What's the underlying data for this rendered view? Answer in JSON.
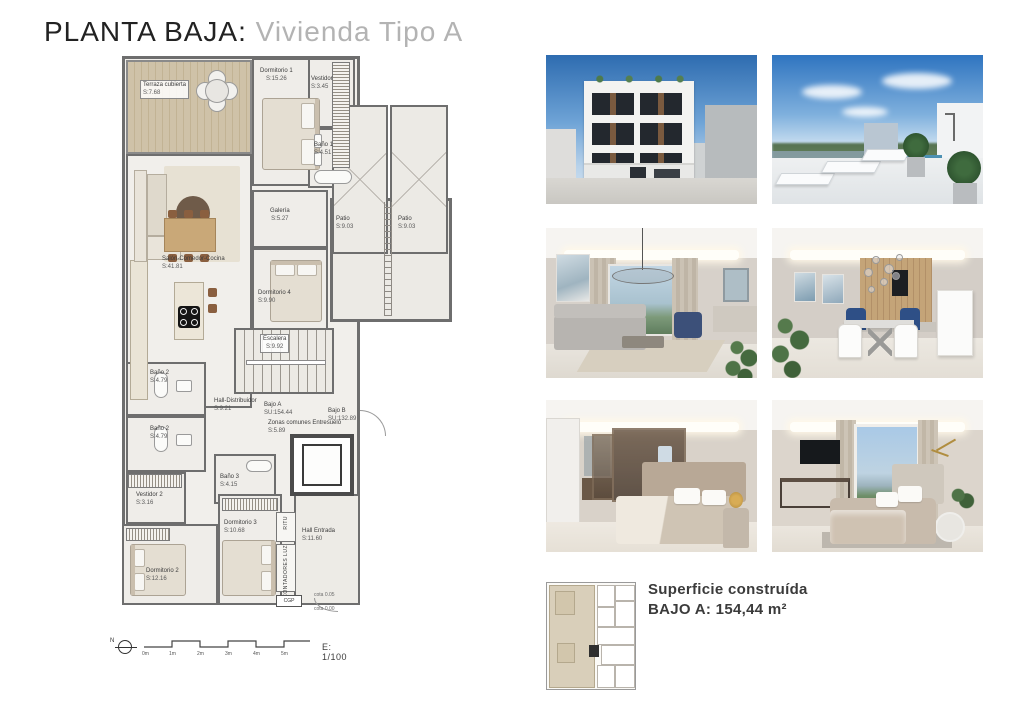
{
  "title": {
    "main": "PLANTA BAJA:",
    "sub": " Vivienda Tipo A"
  },
  "plan": {
    "rooms": [
      {
        "name": "Terraza cubierta",
        "area": "S:7.68"
      },
      {
        "name": "Dormitorio 1",
        "area": "S:15.26"
      },
      {
        "name": "Vestidor",
        "area": "S:3.45"
      },
      {
        "name": "Baño 1",
        "area": "S:4.51"
      },
      {
        "name": "Salón-Comedor-Cocina",
        "area": "S:41.81"
      },
      {
        "name": "Galería",
        "area": "S:5.27"
      },
      {
        "name": "Dormitorio 4",
        "area": "S:9.90"
      },
      {
        "name": "Patio",
        "area": "S:9.03"
      },
      {
        "name": "Patio",
        "area": "S:9.03"
      },
      {
        "name": "Escalera",
        "area": "S:9.92"
      },
      {
        "name": "Baño 2",
        "area": "S:4.79"
      },
      {
        "name": "Baño 2",
        "area": "S:4.79"
      },
      {
        "name": "Hall-Distribuidor",
        "area": "S:9.21"
      },
      {
        "name": "Vestidor 2",
        "area": "S:3.16"
      },
      {
        "name": "Baño 3",
        "area": "S:4.15"
      },
      {
        "name": "Bajo A",
        "area": "SU:154.44"
      },
      {
        "name": "Zonas comunes Entresuelo",
        "area": "S:5.89"
      },
      {
        "name": "Bajo B",
        "area": "SU:132.89"
      },
      {
        "name": "Dormitorio 2",
        "area": "S:12.16"
      },
      {
        "name": "Dormitorio 3",
        "area": "S:10.68"
      },
      {
        "name": "Hall Entrada",
        "area": "S:11.60"
      }
    ],
    "labels": {
      "ritu": "RITU",
      "contadores": "CONTADORES LUZ",
      "cgp": "CGP",
      "cota_a": "cota 0.05",
      "cota_b": "cota 0.00"
    },
    "scale": {
      "north": "N",
      "ticks": [
        "0m",
        "1m",
        "2m",
        "3m",
        "4m",
        "5m"
      ],
      "ratio": "E: 1/100"
    }
  },
  "photos": [
    {
      "name": "building-facade"
    },
    {
      "name": "rooftop-solarium-pool"
    },
    {
      "name": "living-room"
    },
    {
      "name": "dining-kitchen"
    },
    {
      "name": "bedroom-dressing-room"
    },
    {
      "name": "bedroom-with-views"
    }
  ],
  "summary": {
    "line1": "Superficie construída",
    "line2": "BAJO A: 154,44 m²"
  },
  "colors": {
    "title_sub": "#b3b3b3",
    "plan_wall": "#6e6e6e",
    "deck_wood": "#cfc2a8",
    "keyplan_highlight": "#d9cfba"
  }
}
